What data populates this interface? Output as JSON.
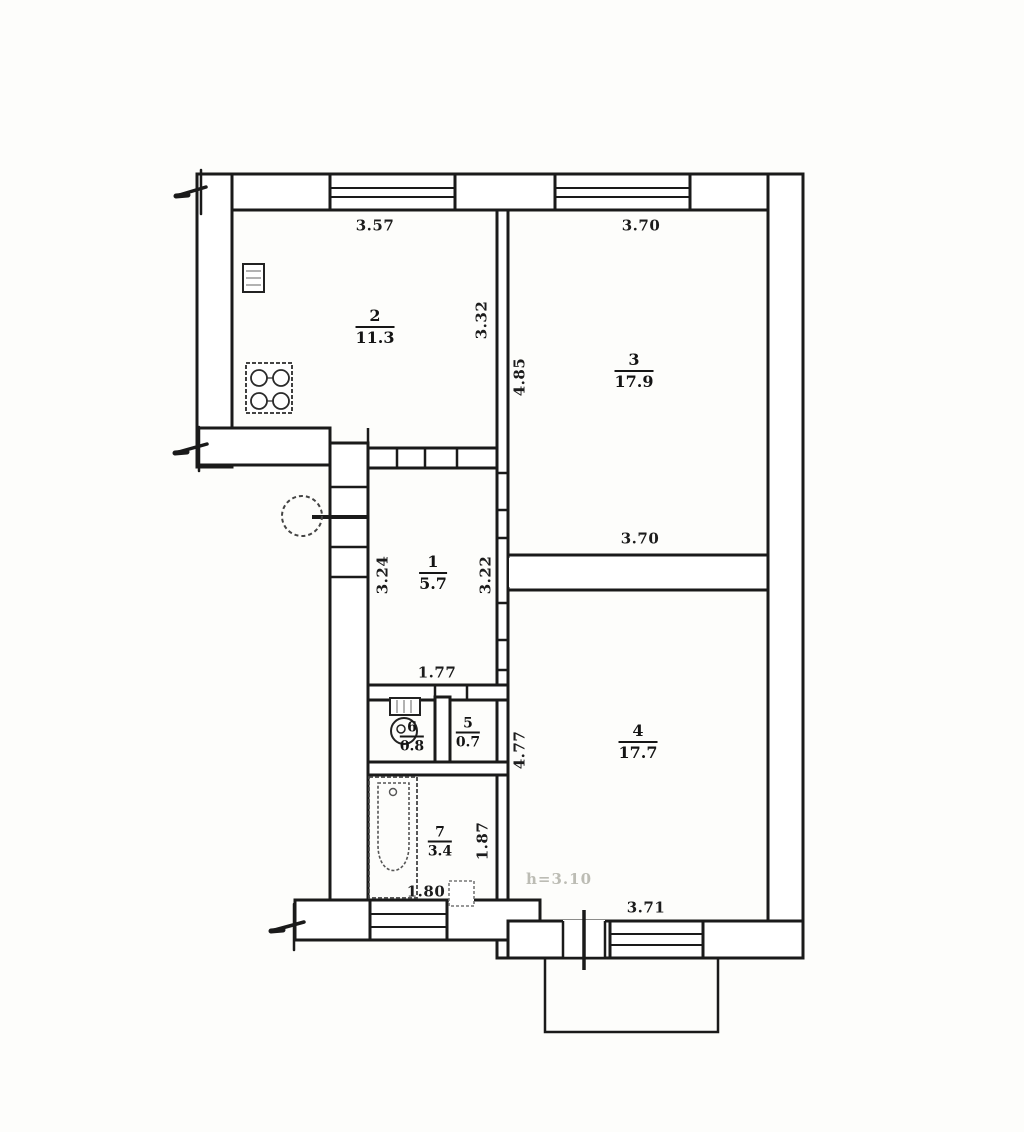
{
  "document": {
    "kind": "apartment floor plan scan"
  },
  "rooms": {
    "r1": {
      "number": "1",
      "area": "5.7",
      "dims": {
        "left": "3.24",
        "right": "3.22",
        "bottom": "1.77"
      }
    },
    "r2": {
      "number": "2",
      "area": "11.3",
      "dims": {
        "top": "3.57",
        "right": "3.32"
      }
    },
    "r3": {
      "number": "3",
      "area": "17.9",
      "dims": {
        "top": "3.70",
        "left": "4.85",
        "bottom": "3.70"
      }
    },
    "r4": {
      "number": "4",
      "area": "17.7",
      "dims": {
        "left": "4.77",
        "bottom": "3.71"
      }
    },
    "r5": {
      "number": "5",
      "area": "0.7",
      "dims": {}
    },
    "r6": {
      "number": "6",
      "area": "0.8",
      "dims": {}
    },
    "r7": {
      "number": "7",
      "area": "3.4",
      "dims": {
        "right": "1.87",
        "bottom": "1.80"
      }
    }
  },
  "annotations": {
    "ceiling_height": "h=3.10"
  },
  "icons": {
    "stove": "stove-icon",
    "kitchen_sink": "sink-icon",
    "water_heater": "water-heater-icon",
    "toilet": "toilet-icon",
    "bathtub": "bathtub-icon",
    "bath_sink": "sink-icon",
    "wall_break": "wall-break-icon"
  },
  "colors": {
    "line": "#1a1a1a",
    "paper": "#fdfdfb",
    "faint": "#bcbcb4"
  }
}
